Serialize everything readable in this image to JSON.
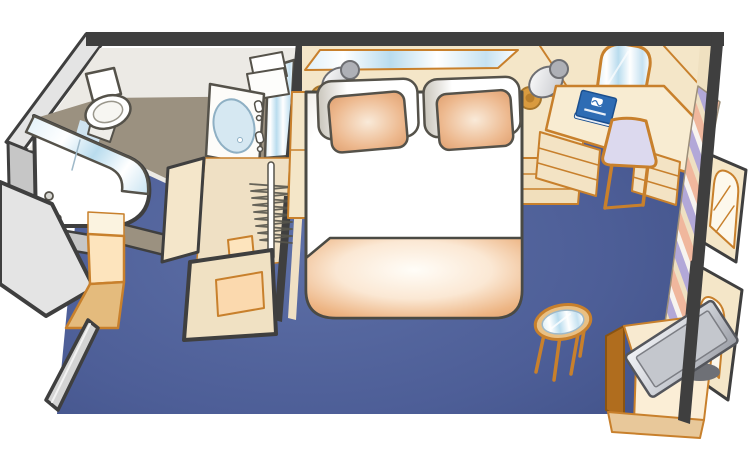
{
  "scene": {
    "title": "Cruise ship stateroom floor plan",
    "type": "isometric-cabin-floorplan",
    "items": {
      "floor": {
        "label": "Blue carpet floor"
      },
      "outer_walls": {
        "label": "Cabin outer walls"
      },
      "bathroom": {
        "label": "Bathroom"
      },
      "shower": {
        "label": "Shower stall with curved glass door"
      },
      "toilet": {
        "label": "Toilet"
      },
      "vanity": {
        "label": "Bathroom sink vanity"
      },
      "towels": {
        "label": "Folded towels"
      },
      "vanity_mirror": {
        "label": "Bathroom mirror"
      },
      "closet": {
        "label": "Open closet"
      },
      "hanger_rod": {
        "label": "Closet rod"
      },
      "hangers": {
        "label": "Clothes hangers"
      },
      "entry": {
        "label": "Entrance hallway"
      },
      "entry_door": {
        "label": "Cabin entry door (open)"
      },
      "entry_cabinet": {
        "label": "Entry cabinet"
      },
      "headboard_wall": {
        "label": "Headboard wall"
      },
      "headboard_mirror": {
        "label": "Mirror strip above headboard"
      },
      "lamp_left": {
        "label": "Left reading lamp"
      },
      "lamp_right": {
        "label": "Right reading lamp"
      },
      "bed": {
        "label": "Queen bed"
      },
      "pillow_left": {
        "label": "Left pillow"
      },
      "pillow_right": {
        "label": "Right pillow"
      },
      "cushion_left": {
        "label": "Left accent cushion"
      },
      "cushion_right": {
        "label": "Right accent cushion"
      },
      "blanket": {
        "label": "Peach foot blanket"
      },
      "nightstand_left": {
        "label": "Left nightstand"
      },
      "nightstand_right": {
        "label": "Right nightstand with drawers"
      },
      "desk": {
        "label": "Writing desk"
      },
      "desk_mirror": {
        "label": "Arched mirror above desk"
      },
      "desk_drawers": {
        "label": "Desk drawers"
      },
      "chair": {
        "label": "Desk chair"
      },
      "book": {
        "label": "Blue cruise-line information book on desk"
      },
      "curtain": {
        "label": "Striped privacy curtain"
      },
      "wardrobe_upper": {
        "label": "Wardrobe door with arched panel"
      },
      "wardrobe_lower": {
        "label": "Lower wardrobe door with arched panel"
      },
      "tv": {
        "label": "Flat-screen television"
      },
      "tv_cabinet": {
        "label": "TV cabinet"
      },
      "side_table": {
        "label": "Round glass side table"
      }
    }
  },
  "colors": {
    "page_bg": "#ffffff",
    "wall_dark": "#3f3f3f",
    "furniture_outline": "#55524a",
    "wood_outline": "#c8802c",
    "wall_beige": "#f4e6c8",
    "wall_beige_shadow": "#eddbb6",
    "cream": "#fbf3e0",
    "carpet_dark": "#3c4c82",
    "carpet": "#4d5e97",
    "carpet_light": "#5d6fa6",
    "bathroom_floor": "#9b9180",
    "bathroom_wall_light": "#eceae5",
    "wall_gray_light": "#e4e4e4",
    "wall_gray_mid": "#c6c6c6",
    "glass_blue": "#bcdcee",
    "peach": "#e09f6b",
    "peach_pale": "#fde4bd",
    "peach_mid": "#e4bb7d",
    "wood_brown": "#b06d1e",
    "lavender": "#dcd9ee",
    "curtain_lavender": "#b2a8d8",
    "curtain_salmon": "#f0b79d",
    "curtain_cream": "#eee0c2",
    "book_blue": "#2e6cb4",
    "tv_gray": "#9a9da5",
    "table_wood": "#e9c084"
  }
}
